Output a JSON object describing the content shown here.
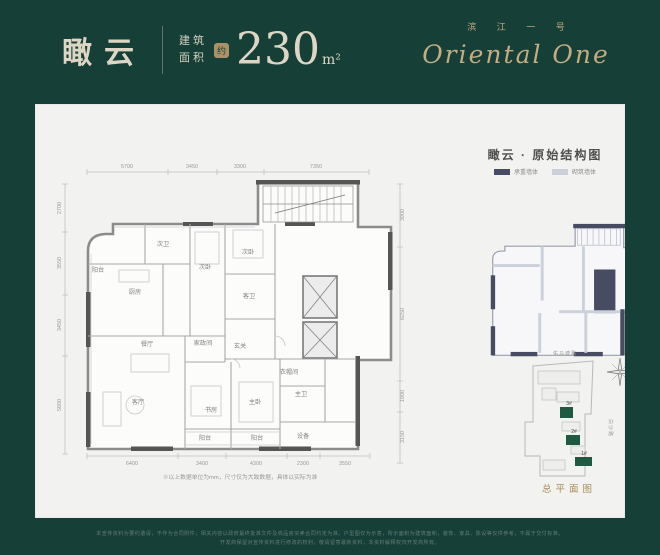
{
  "header": {
    "unit_name": "瞰云",
    "area_label_line1": "建筑",
    "area_label_line2": "面积",
    "approx_badge": "约",
    "area_value": "230",
    "area_unit": "m²",
    "brand_cn": "滨 江 一 号",
    "brand_en": "Oriental One"
  },
  "panel": {
    "structure_title": "瞰云 · 原始结构图",
    "legend": [
      {
        "label": "承重墙体",
        "color": "#474c63"
      },
      {
        "label": "砌筑墙体",
        "color": "#ccd0da"
      }
    ],
    "note": "※以上数据单位为mm，尺寸仅为大致数据，具体以实际为准"
  },
  "floorplan": {
    "rooms": [
      {
        "text": "阳台",
        "x": 63,
        "y": 168
      },
      {
        "text": "厨房",
        "x": 100,
        "y": 190
      },
      {
        "text": "次卫",
        "x": 128,
        "y": 142
      },
      {
        "text": "次卧",
        "x": 170,
        "y": 165
      },
      {
        "text": "次卧",
        "x": 213,
        "y": 150
      },
      {
        "text": "客卫",
        "x": 214,
        "y": 194
      },
      {
        "text": "玄关",
        "x": 205,
        "y": 244
      },
      {
        "text": "衣帽间",
        "x": 254,
        "y": 270
      },
      {
        "text": "餐厅",
        "x": 112,
        "y": 242
      },
      {
        "text": "家政间",
        "x": 168,
        "y": 241
      },
      {
        "text": "客厅",
        "x": 103,
        "y": 300
      },
      {
        "text": "书房",
        "x": 176,
        "y": 308
      },
      {
        "text": "主卧",
        "x": 220,
        "y": 300
      },
      {
        "text": "主卫",
        "x": 266,
        "y": 292
      },
      {
        "text": "阳台",
        "x": 170,
        "y": 336
      },
      {
        "text": "阳台",
        "x": 222,
        "y": 336
      },
      {
        "text": "设备",
        "x": 268,
        "y": 334
      }
    ],
    "dim_labels": [
      {
        "text": "5700",
        "x": 92,
        "y": 64
      },
      {
        "text": "3450",
        "x": 157,
        "y": 64
      },
      {
        "text": "3300",
        "x": 205,
        "y": 64
      },
      {
        "text": "7350",
        "x": 281,
        "y": 64
      },
      {
        "text": "6400",
        "x": 97,
        "y": 361
      },
      {
        "text": "3400",
        "x": 167,
        "y": 361
      },
      {
        "text": "4300",
        "x": 221,
        "y": 361
      },
      {
        "text": "2300",
        "x": 268,
        "y": 361
      },
      {
        "text": "3550",
        "x": 310,
        "y": 361
      },
      {
        "text": "2700",
        "x": 26,
        "y": 104,
        "rot": -90
      },
      {
        "text": "3550",
        "x": 26,
        "y": 159,
        "rot": -90
      },
      {
        "text": "3450",
        "x": 26,
        "y": 221,
        "rot": -90
      },
      {
        "text": "5600",
        "x": 26,
        "y": 301,
        "rot": -90
      },
      {
        "text": "3900",
        "x": 369,
        "y": 111,
        "rot": -90
      },
      {
        "text": "8250",
        "x": 369,
        "y": 210,
        "rot": -90
      },
      {
        "text": "1900",
        "x": 369,
        "y": 292,
        "rot": -90
      },
      {
        "text": "3150",
        "x": 369,
        "y": 333,
        "rot": -90
      }
    ]
  },
  "siteplan": {
    "caption": "总平面图",
    "road_top": "佑马塘路",
    "road_right": "白沙路",
    "building_color": "#1e5a41",
    "buildings": [
      {
        "text": "3#",
        "x": 534,
        "y": 301,
        "rx": 525,
        "ry": 303,
        "w": 13,
        "h": 11
      },
      {
        "text": "2#",
        "x": 539,
        "y": 329,
        "rx": 531,
        "ry": 331,
        "w": 14,
        "h": 10
      },
      {
        "text": "1#",
        "x": 549,
        "y": 351,
        "rx": 540,
        "ry": 353,
        "w": 17,
        "h": 9
      }
    ]
  },
  "footer": {
    "line1": "本宣传资料为要约邀请，不作为合同附件，相关内容以政府最终批准文件及商品房买卖合同约定为准。户型图仅为示意，所示面积为建筑面积，装饰、家具、陈设等仅供参考，不属于交付标准。",
    "line2": "开发商保留对宣传资料进行修改的权利，敬请留意最新资料，本资料解释权归开发商所有。"
  }
}
